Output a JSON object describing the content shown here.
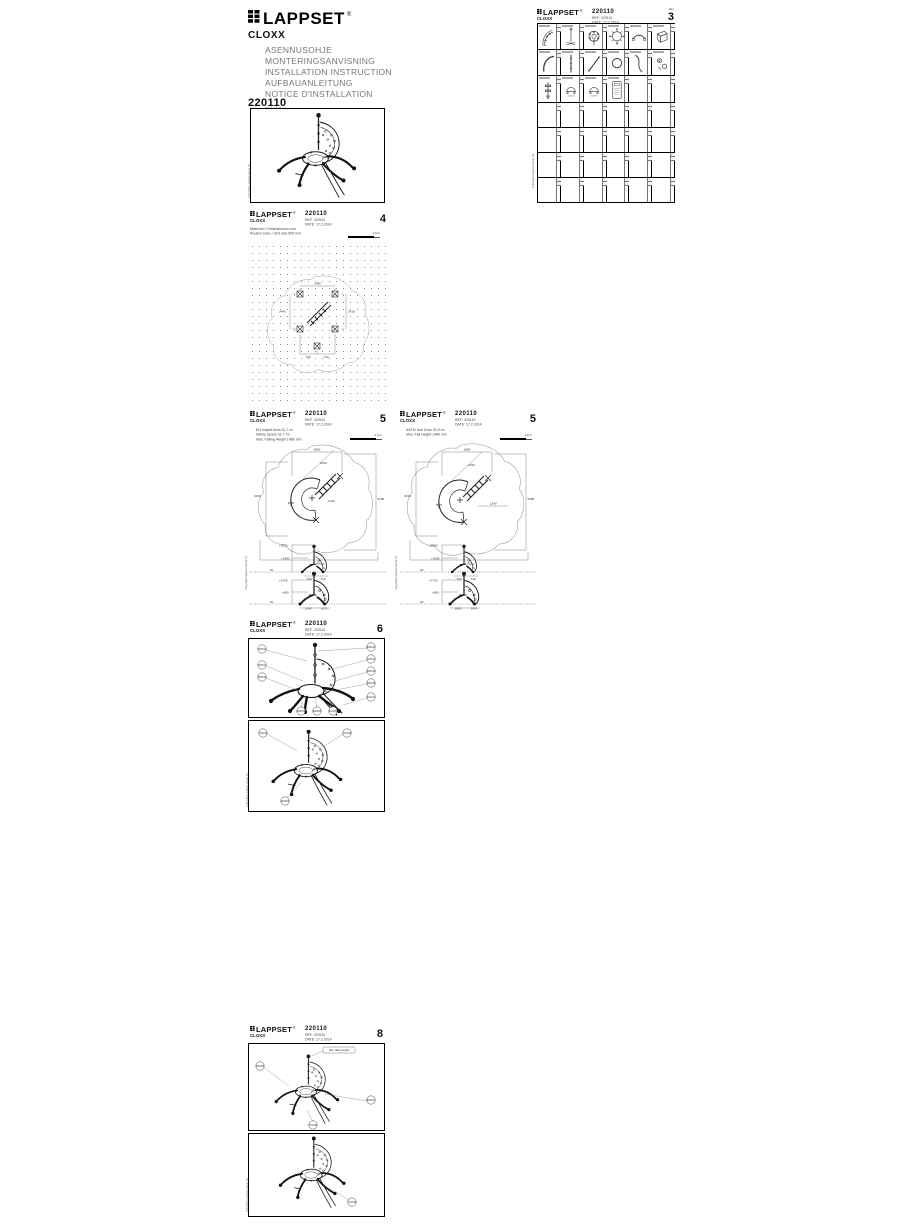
{
  "brand": {
    "logo_text": "LAPPSET",
    "registered": "®",
    "product": "CLOXX"
  },
  "cover": {
    "titles": [
      "ASENNUSOHJE",
      "MONTERINGSANVISNING",
      "INSTALLATION  INSTRUCTION",
      "AUFBAUANLEITUNG",
      "NOTICE  D'INSTALLATION"
    ],
    "ref_line": "REF:    220110",
    "date_line": "DATE:  17.2.2014",
    "product_code_heading": "220110"
  },
  "sheet": {
    "code": "220110",
    "ref_line": "REF:    220110",
    "date_line": "DATE:  17.2.2014"
  },
  "copyright": "Copyright Lappset Group Oy",
  "pages": {
    "parts": {
      "number": "3",
      "sheet_of": "1(1)"
    },
    "plan": {
      "number": "4",
      "notes": [
        "Mitat mm / Dimensions in mm",
        "Ruudun koko / Grid size 500 mm"
      ],
      "scale_label": "1.0 m",
      "dims": {
        "top": "1480",
        "left": "2440",
        "right": "2410",
        "b1": "740",
        "b2": "740"
      }
    },
    "safety_a": {
      "number": "5",
      "notes": [
        "EN  Impact Area 31,7 m²",
        "Safety Space 31,7 m²",
        "Max. Falling Height 1480 mm"
      ],
      "scale_label": "1.0 m",
      "dims": {
        "top": "1860",
        "left": "3430",
        "right": "5180",
        "bottom": "6460",
        "d1": "2150",
        "d2": "1240"
      },
      "elev1": {
        "t": "+2850",
        "m": "+1480",
        "g": "±0",
        "w1": "790",
        "w2": "740"
      },
      "elev2": {
        "t": "+1750",
        "m": "+890",
        "g": "±0",
        "w1": "1240",
        "w2": "1070"
      }
    },
    "safety_b": {
      "number": "5",
      "notes": [
        "ASTM  Use Zone 32,9 m²",
        "Max. Fall Height 1480 mm"
      ],
      "scale_label": "1.0 m",
      "dims": {
        "top": "1860",
        "left": "3430",
        "right": "5480",
        "bottom": "6760",
        "d1": "2150",
        "d2": "1240"
      },
      "elev1": {
        "t": "+2850",
        "m": "+1480",
        "g": "±0",
        "w1": "790",
        "w2": "740"
      },
      "elev2": {
        "t": "+1750",
        "m": "+890",
        "g": "±0",
        "w1": "1830",
        "w2": "1070"
      }
    },
    "assembly": {
      "number": "6",
      "balloons_left": [
        "000510",
        "000512",
        "000514"
      ],
      "balloons_right": [
        "800101",
        "003110",
        "000511",
        "452015",
        "910101"
      ],
      "balloons_bottom": [
        "920249",
        "920250",
        "910040"
      ],
      "balloons_b": [
        "701015",
        "701016",
        "920251"
      ]
    },
    "anchoring": {
      "number": "8",
      "note": "Max. falling height",
      "balloons_a": [
        "800250",
        "800137",
        "701040"
      ],
      "balloons_b": [
        "701045"
      ]
    }
  }
}
